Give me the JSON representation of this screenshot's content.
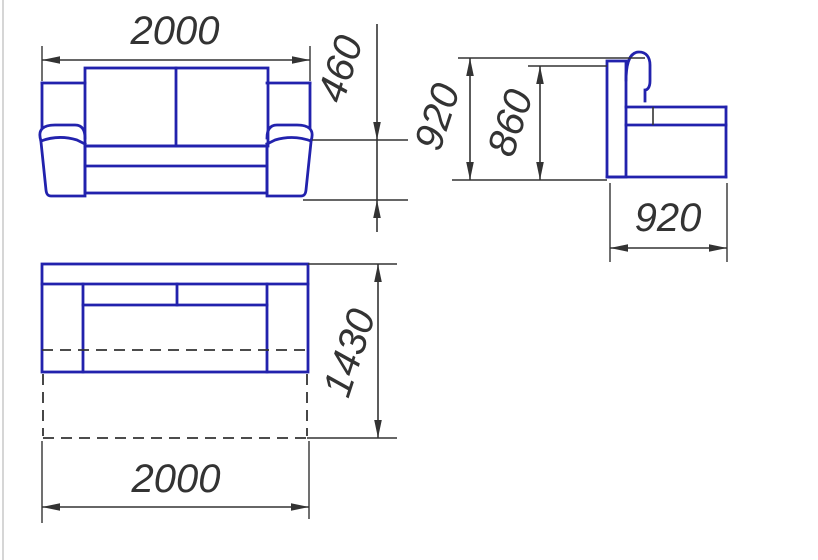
{
  "drawing": {
    "kind": "sofa-orthographic-dimension-drawing",
    "views": {
      "front": {
        "width_mm": "2000",
        "seat_height_mm": "460"
      },
      "side": {
        "overall_height_mm": "920",
        "back_height_mm": "860",
        "depth_mm": "920"
      },
      "plan": {
        "unfolded_depth_mm": "1430",
        "width_mm": "2000"
      }
    }
  },
  "colors": {
    "furniture_outline": "#2222ad",
    "dimension_lines": "#333333",
    "background": "#ffffff",
    "photo_edge": "#c9c9c9"
  }
}
